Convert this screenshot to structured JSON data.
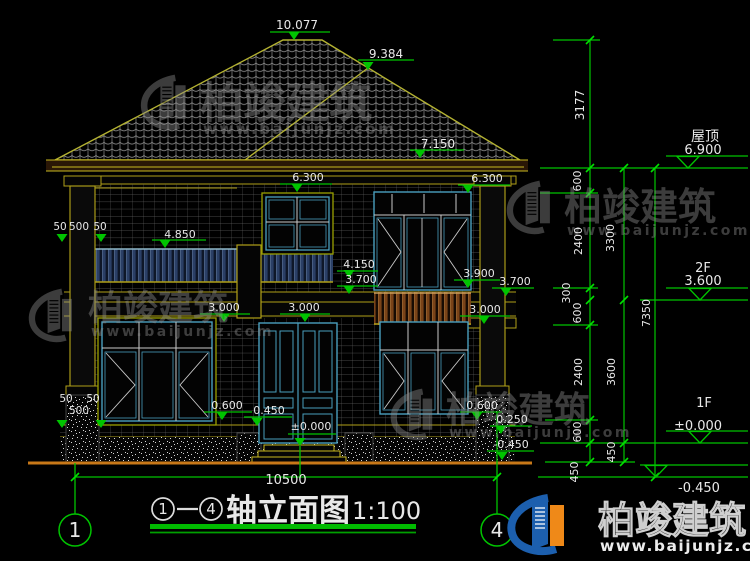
{
  "title": {
    "bubble_start": "1",
    "bubble_end": "4",
    "name": "轴立面图",
    "scale": "1:100"
  },
  "axis": {
    "left": "1",
    "right": "4"
  },
  "watermark": {
    "brand": "柏竣建筑",
    "url": "www.baijunjz.com"
  },
  "logo": {
    "brand": "柏竣建筑",
    "url": "www.baijunjz.com"
  },
  "colors": {
    "annotation_green": "#00c400",
    "cad_olive": "#b0a018",
    "roof_line": "#b4b232",
    "window_teal": "#4a9fbe",
    "ground_orange": "#c87818",
    "logo_blue": "#1c5fae",
    "logo_orange": "#ef8918"
  },
  "annotations": [
    {
      "name": "elev-10077",
      "text": "10.077",
      "x": 297,
      "y": 29,
      "size": 12
    },
    {
      "name": "elev-9384",
      "text": "9.384",
      "x": 386,
      "y": 58,
      "size": 12
    },
    {
      "name": "elev-7150",
      "text": "7.150",
      "x": 438,
      "y": 148,
      "size": 12
    },
    {
      "name": "elev-6300-left",
      "text": "6.300",
      "x": 308,
      "y": 181,
      "size": 11
    },
    {
      "name": "elev-6300-right",
      "text": "6.300",
      "x": 487,
      "y": 182,
      "size": 11
    },
    {
      "name": "elev-4850",
      "text": "4.850",
      "x": 180,
      "y": 238,
      "size": 11
    },
    {
      "name": "elev-4150",
      "text": "4.150",
      "x": 359,
      "y": 268,
      "size": 11
    },
    {
      "name": "elev-3700-mid",
      "text": "3.700",
      "x": 361,
      "y": 283,
      "size": 11
    },
    {
      "name": "elev-3900",
      "text": "3.900",
      "x": 479,
      "y": 277,
      "size": 11
    },
    {
      "name": "elev-3700-right",
      "text": "3.700",
      "x": 515,
      "y": 285,
      "size": 11
    },
    {
      "name": "elev-3000-left",
      "text": "3.000",
      "x": 224,
      "y": 311,
      "size": 11
    },
    {
      "name": "elev-3000-mid",
      "text": "3.000",
      "x": 304,
      "y": 311,
      "size": 11
    },
    {
      "name": "elev-3000-right",
      "text": "3.000",
      "x": 485,
      "y": 313,
      "size": 11
    },
    {
      "name": "elev-0600-left",
      "text": "0.600",
      "x": 227,
      "y": 409,
      "size": 11
    },
    {
      "name": "elev-0450-door",
      "text": "0.450",
      "x": 269,
      "y": 414,
      "size": 11
    },
    {
      "name": "elev-0000-door",
      "text": "±0.000",
      "x": 311,
      "y": 430,
      "size": 11
    },
    {
      "name": "elev-0600-right",
      "text": "0.600",
      "x": 482,
      "y": 409,
      "size": 11
    },
    {
      "name": "elev-0250",
      "text": "0.250",
      "x": 512,
      "y": 423,
      "size": 11
    },
    {
      "name": "elev-neg0450-wall",
      "text": "-0.450",
      "x": 511,
      "y": 448,
      "size": 11
    },
    {
      "name": "dim-50-upper-a",
      "text": "50",
      "x": 60,
      "y": 230,
      "size": 10.5
    },
    {
      "name": "dim-500-upper",
      "text": "500",
      "x": 79,
      "y": 230,
      "size": 10.5
    },
    {
      "name": "dim-50-upper-b",
      "text": "50",
      "x": 100,
      "y": 230,
      "size": 10.5
    },
    {
      "name": "dim-50-lower-a",
      "text": "50",
      "x": 66,
      "y": 402,
      "size": 10.5
    },
    {
      "name": "dim-50-lower-b",
      "text": "50",
      "x": 93,
      "y": 402,
      "size": 10.5
    },
    {
      "name": "dim-500-lower",
      "text": "500",
      "x": 79,
      "y": 414,
      "size": 10.5
    },
    {
      "name": "dim-10500",
      "text": "10500",
      "x": 286,
      "y": 484,
      "size": 13
    },
    {
      "name": "dim-3177",
      "text": "3177",
      "x": 584,
      "y": 105,
      "rotate": -90,
      "size": 12
    },
    {
      "name": "dim-600-a",
      "text": "600",
      "x": 581,
      "y": 181,
      "rotate": -90,
      "size": 11
    },
    {
      "name": "dim-2400-a",
      "text": "2400",
      "x": 582,
      "y": 241,
      "rotate": -90,
      "size": 11
    },
    {
      "name": "dim-300",
      "text": "300",
      "x": 570,
      "y": 293,
      "rotate": -90,
      "size": 11
    },
    {
      "name": "dim-600-b",
      "text": "600",
      "x": 581,
      "y": 313,
      "rotate": -90,
      "size": 11
    },
    {
      "name": "dim-2400-b",
      "text": "2400",
      "x": 582,
      "y": 372,
      "rotate": -90,
      "size": 11
    },
    {
      "name": "dim-600-c",
      "text": "600",
      "x": 581,
      "y": 432,
      "rotate": -90,
      "size": 11
    },
    {
      "name": "dim-450-a",
      "text": "450",
      "x": 578,
      "y": 472,
      "rotate": -90,
      "size": 11
    },
    {
      "name": "dim-3300",
      "text": "3300",
      "x": 614,
      "y": 238,
      "rotate": -90,
      "size": 11
    },
    {
      "name": "dim-3600",
      "text": "3600",
      "x": 615,
      "y": 372,
      "rotate": -90,
      "size": 11
    },
    {
      "name": "dim-450-b",
      "text": "450",
      "x": 615,
      "y": 452,
      "rotate": -90,
      "size": 11
    },
    {
      "name": "dim-7350",
      "text": "7350",
      "x": 650,
      "y": 313,
      "rotate": -90,
      "size": 11
    },
    {
      "name": "level-roof-label",
      "text": "屋顶",
      "x": 705,
      "y": 141,
      "size": 14
    },
    {
      "name": "level-roof-value",
      "text": "6.900",
      "x": 703,
      "y": 154,
      "size": 13
    },
    {
      "name": "level-2f-label",
      "text": "2F",
      "x": 703,
      "y": 272,
      "size": 13
    },
    {
      "name": "level-2f-value",
      "text": "3.600",
      "x": 703,
      "y": 285,
      "size": 13
    },
    {
      "name": "level-1f-label",
      "text": "1F",
      "x": 704,
      "y": 407,
      "size": 13
    },
    {
      "name": "level-1f-value",
      "text": "±0.000",
      "x": 698,
      "y": 430,
      "size": 13
    },
    {
      "name": "level-ground-value",
      "text": "-0.450",
      "x": 699,
      "y": 492,
      "size": 13
    }
  ]
}
